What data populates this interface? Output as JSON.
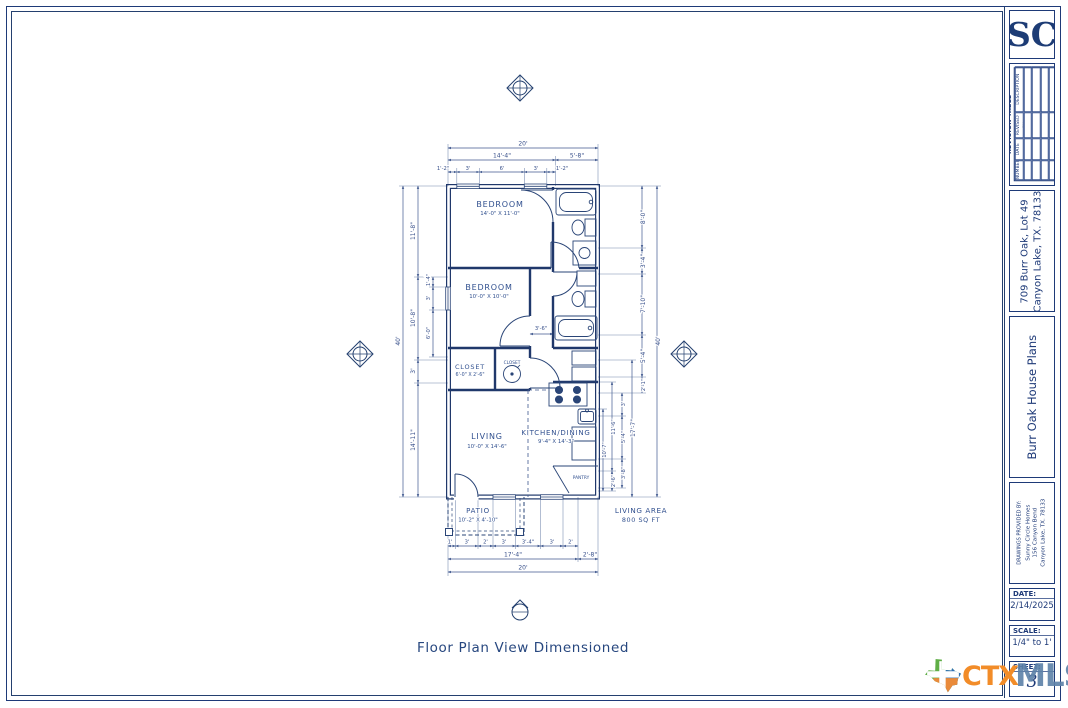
{
  "titleblock": {
    "logo": "SC",
    "revision": {
      "title": "REVISION TABLE",
      "columns": [
        "NUMBER",
        "DATE",
        "REVISED BY",
        "DESCRIPTION"
      ]
    },
    "address": {
      "line1": "709 Burr Oak, Lot 49",
      "line2": "Canyon Lake, TX. 78133"
    },
    "project": "Burr Oak House Plans",
    "provided_by": {
      "label": "DRAWINGS PROVIDED BY:",
      "lines": [
        "Sunny Circle Homes",
        "156 Canyon Bend",
        "Canyon Lake, TX. 78133"
      ]
    },
    "date": {
      "label": "DATE:",
      "value": "2/14/2025"
    },
    "scale": {
      "label": "SCALE:",
      "value": "1/4\" to 1'"
    },
    "sheet": {
      "label": "SHEET:",
      "value": "3"
    }
  },
  "footer_logo": {
    "ctx": "CTX",
    "mls": "MLS",
    "ctx_color": "#f28c28",
    "mls_color": "#5d81a8"
  },
  "caption": "Floor Plan View Dimensioned",
  "plan": {
    "note": {
      "line1": "LIVING AREA",
      "line2": "800 SQ FT"
    },
    "rooms": {
      "bedroom1": {
        "name": "BEDROOM",
        "size": "14'-0\" X 11'-0\""
      },
      "bedroom2": {
        "name": "BEDROOM",
        "size": "10'-0\" X 10'-0\""
      },
      "closet1": {
        "name": "CLOSET",
        "size": "6'-0\" X 2'-6\""
      },
      "closet2": {
        "name": "CLOSET"
      },
      "living": {
        "name": "LIVING",
        "size": "10'-0\" X 14'-6\""
      },
      "kitchen": {
        "name": "KITCHEN/DINING",
        "size": "9'-4\" X 14'-3\""
      },
      "pantry": {
        "name": "PANTRY"
      },
      "patio": {
        "name": "PATIO",
        "size": "10'-2\" X 4'-10\""
      }
    },
    "dims": {
      "top": [
        "20'",
        "14'-4\"",
        "5'-8\"",
        "1'-2\"",
        "3'",
        "6'",
        "3'",
        "1'-2\""
      ],
      "bottom": [
        "1'",
        "3'",
        "2'",
        "3'",
        "3'-4\"",
        "3'",
        "2'",
        "17'-4\"",
        "2'-8\"",
        "20'"
      ],
      "left": [
        "40'",
        "11'-8\"",
        "10'-8\"",
        "3'",
        "14'-11\"",
        "1'-4\"",
        "3'",
        "6'-0\""
      ],
      "right": [
        "40'",
        "8'-0\"",
        "3'-4\"",
        "7'-10\"",
        "5'-4\"",
        "2'-1\"",
        "17'-7\"",
        "3'",
        "5'-4\"",
        "3'-8\"",
        "11'-6\"",
        "2'-6\"",
        "10'-7\""
      ],
      "hall": "3'-6\""
    }
  }
}
